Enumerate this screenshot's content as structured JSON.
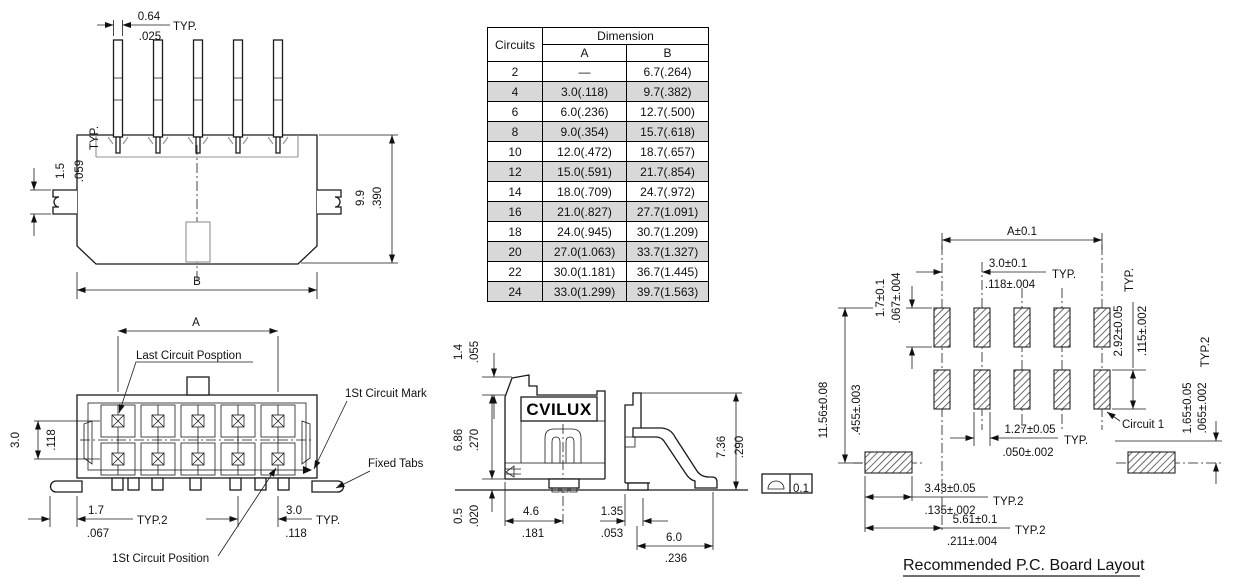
{
  "table": {
    "circuits_header": "Circuits",
    "dimension_header": "Dimension",
    "col_a": "A",
    "col_b": "B",
    "rows": [
      {
        "c": "2",
        "a": "—",
        "b": "6.7(.264)"
      },
      {
        "c": "4",
        "a": "3.0(.118)",
        "b": "9.7(.382)"
      },
      {
        "c": "6",
        "a": "6.0(.236)",
        "b": "12.7(.500)"
      },
      {
        "c": "8",
        "a": "9.0(.354)",
        "b": "15.7(.618)"
      },
      {
        "c": "10",
        "a": "12.0(.472)",
        "b": "18.7(.657)"
      },
      {
        "c": "12",
        "a": "15.0(.591)",
        "b": "21.7(.854)"
      },
      {
        "c": "14",
        "a": "18.0(.709)",
        "b": "24.7(.972)"
      },
      {
        "c": "16",
        "a": "21.0(.827)",
        "b": "27.7(1.091)"
      },
      {
        "c": "18",
        "a": "24.0(.945)",
        "b": "30.7(1.209)"
      },
      {
        "c": "20",
        "a": "27.0(1.063)",
        "b": "33.7(1.327)"
      },
      {
        "c": "22",
        "a": "30.0(1.181)",
        "b": "36.7(1.445)"
      },
      {
        "c": "24",
        "a": "33.0(1.299)",
        "b": "39.7(1.563)"
      }
    ]
  },
  "top_view": {
    "pin_width_mm": "0.64",
    "pin_width_in": ".025",
    "pin_width_typ": "TYP.",
    "tab_mm": "1.5",
    "tab_in": ".059",
    "tab_typ": "TYP.",
    "height_mm": "9.9",
    "height_in": ".390"
  },
  "front_view": {
    "overall_label": "B",
    "span_label": "A",
    "last_circuit": "Last Circuit Posption",
    "first_circuit_mark": "1St Circuit Mark",
    "fixed_tabs": "Fixed Tabs",
    "first_circuit_position": "1St Circuit Position",
    "row_pitch_mm": "3.0",
    "row_pitch_in": ".118",
    "tab_offset_mm": "1.7",
    "tab_offset_in": ".067",
    "tab_offset_typ": "TYP.2",
    "pitch_mm": "3.0",
    "pitch_in": ".118",
    "pitch_typ": "TYP."
  },
  "side_view": {
    "logo": "CVILUX",
    "latch_mm": "1.4",
    "latch_in": ".055",
    "height_mm": "6.86",
    "height_in": ".270",
    "standoff_mm": "0.5",
    "standoff_in": ".020",
    "center_mm": "4.6",
    "center_in": ".181",
    "lead_mm": "1.35",
    "lead_in": ".053",
    "foot_mm": "6.0",
    "foot_in": ".236",
    "overall_mm": "7.36",
    "overall_in": ".290",
    "flatness": "0.1"
  },
  "pcb": {
    "span": "A±0.1",
    "pitch_mm": "3.0±0.1",
    "pitch_in": ".118±.004",
    "pitch_typ": "TYP.",
    "pad_len_mm": "1.7±0.1",
    "pad_len_in": ".067±.004",
    "overall_mm": "11.56±0.08",
    "overall_in": ".455±.003",
    "row_mm": "2.92±0.05",
    "row_in": ".115±.002",
    "row_typ": "TYP.",
    "corner_typ": "TYP.2",
    "pad_w_mm": "1.27±0.05",
    "pad_w_in": ".050±.002",
    "pad_w_typ": "TYP.",
    "nail_v_mm": "1.65±0.05",
    "nail_v_in": ".065±.002",
    "nail_w_mm": "3.43±0.05",
    "nail_w_in": ".135±.002",
    "nail_w_typ": "TYP.2",
    "nail_off_mm": "5.61±0.1",
    "nail_off_in": ".211±.004",
    "nail_off_typ": "TYP.2",
    "circuit1": "Circuit 1",
    "title": "Recommended P.C. Board Layout"
  }
}
